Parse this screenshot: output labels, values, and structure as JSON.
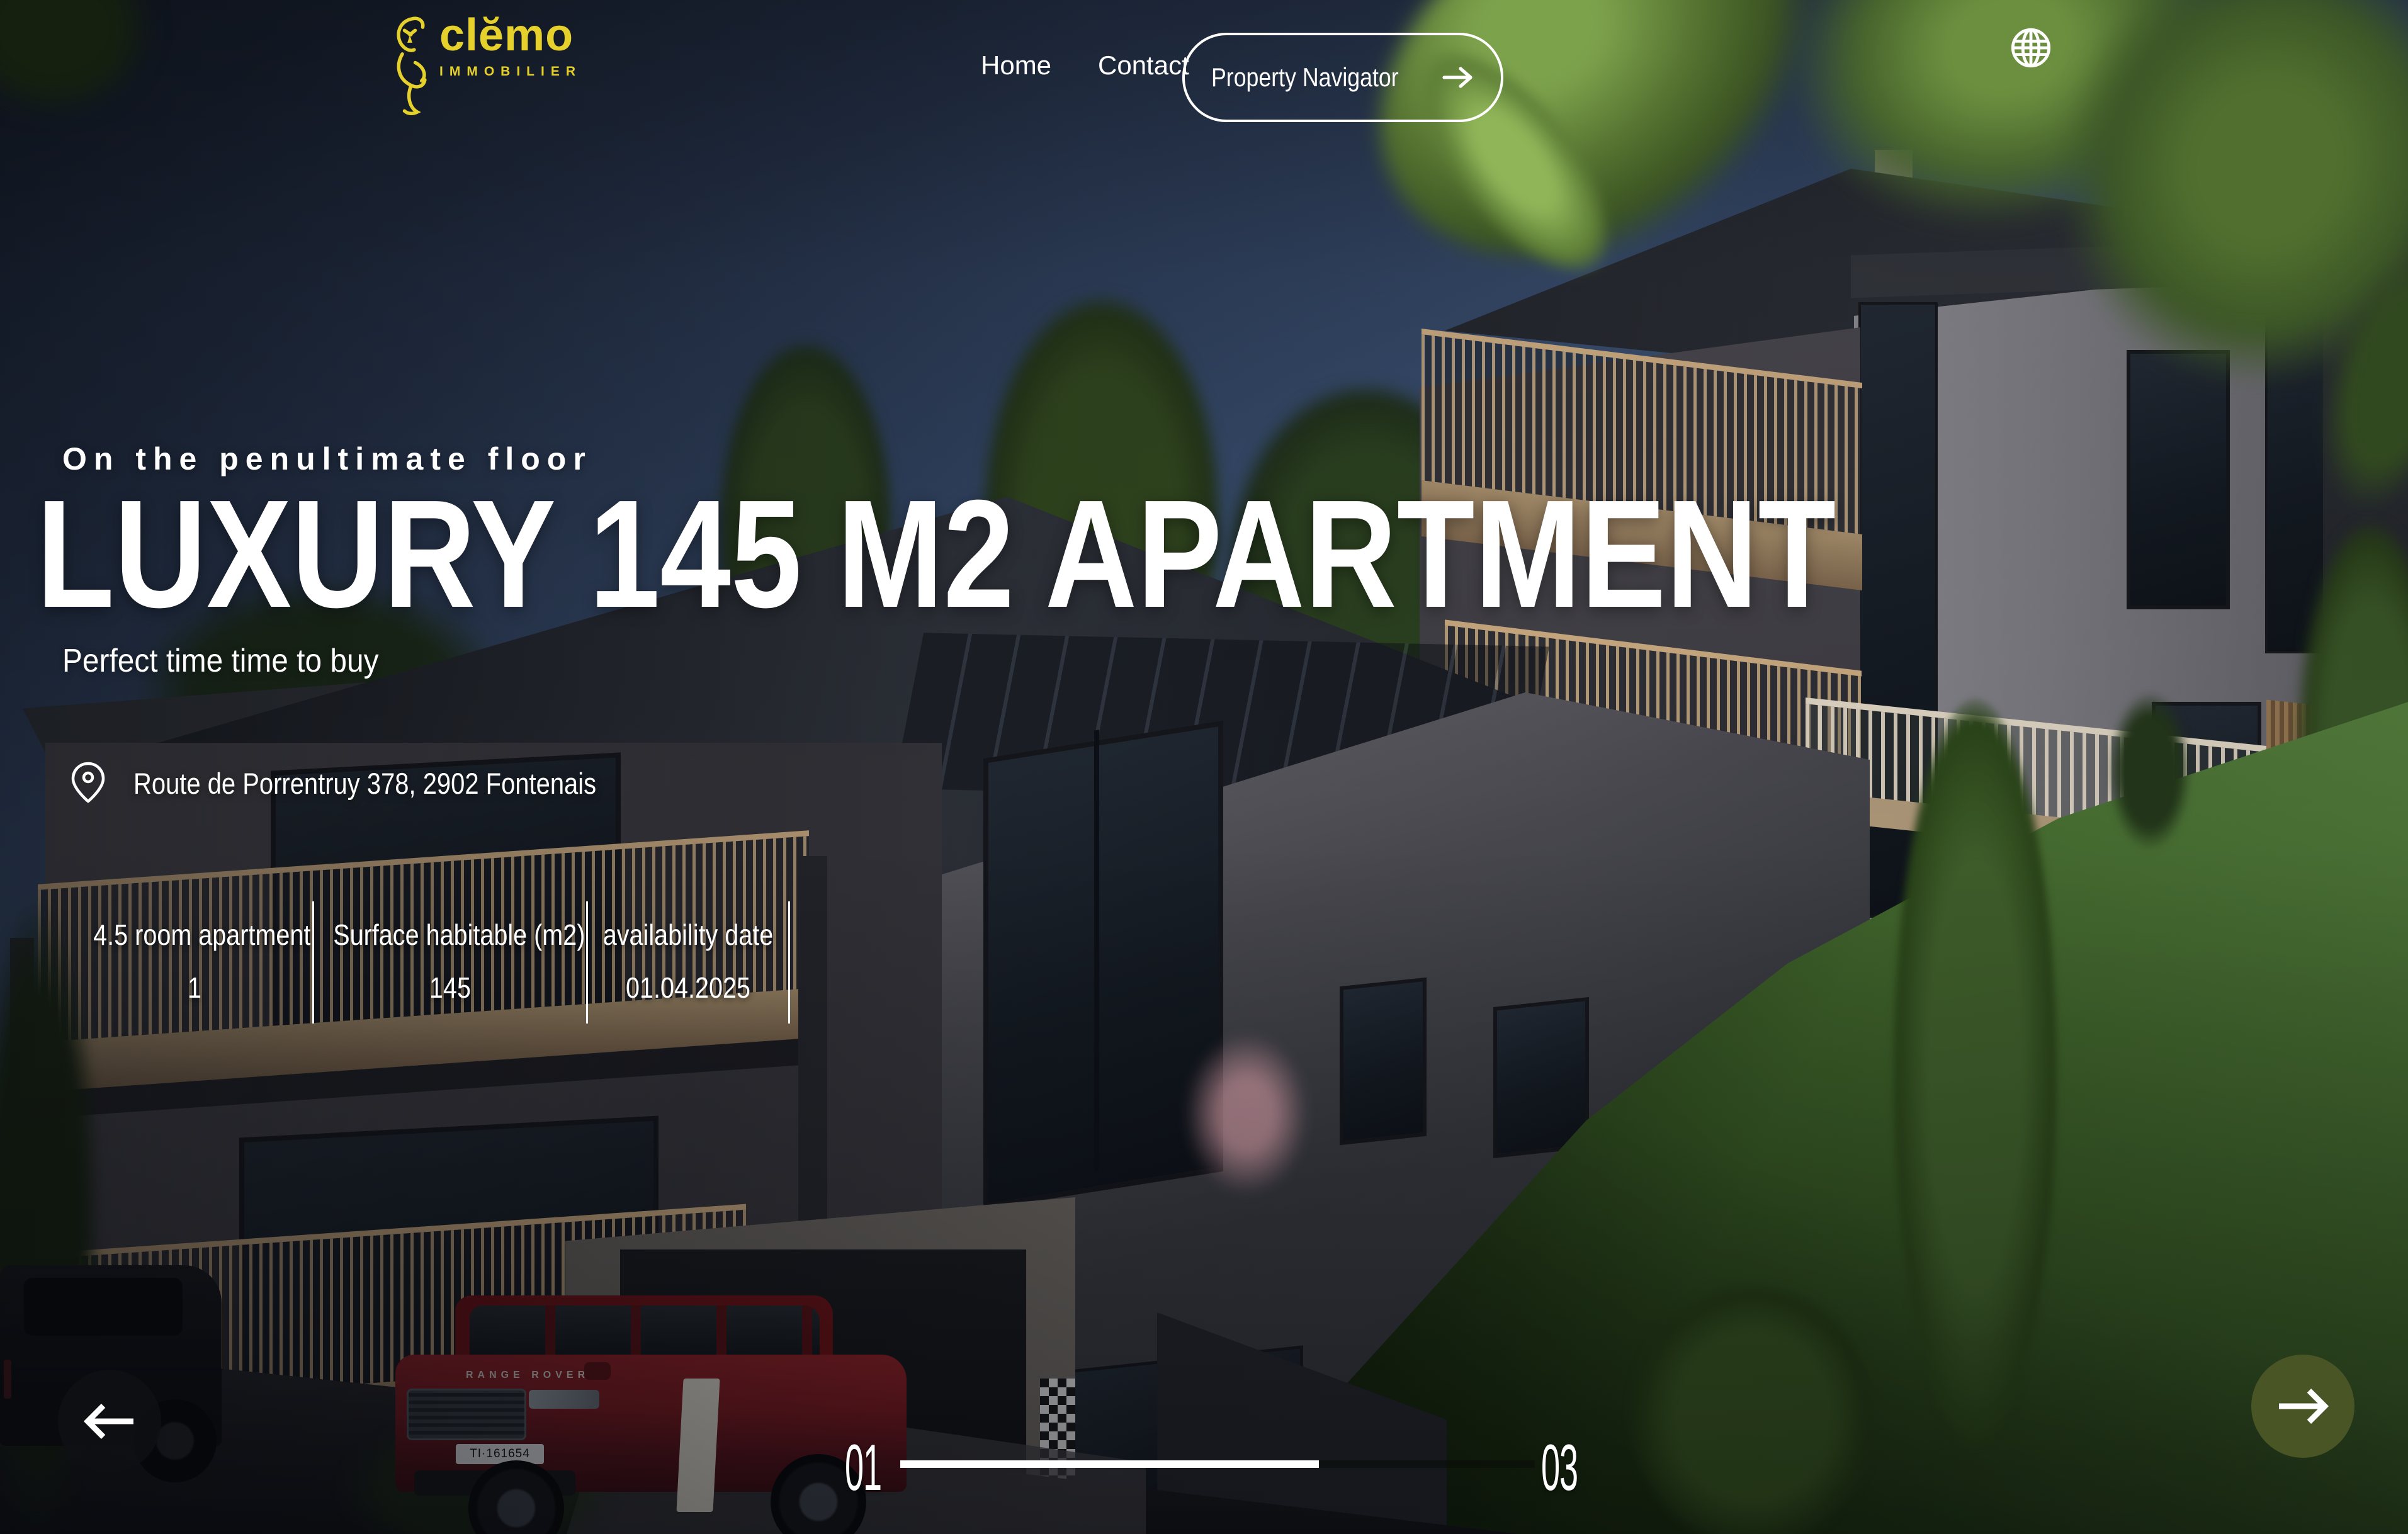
{
  "brand": {
    "name": "clĕmo",
    "subtitle": "IMMOBILIER",
    "accent_color": "#e6d02b"
  },
  "nav": {
    "home": "Home",
    "contact": "Contact",
    "cta": "Property Navigator"
  },
  "hero": {
    "eyebrow": "On the penultimate floor",
    "title": "LUXURY 145 M2 APARTMENT",
    "subtitle": "Perfect time time to buy",
    "address": "Route de Porrentruy 378, 2902 Fontenais",
    "stats": [
      {
        "label": "4.5 room apartment",
        "value": "1"
      },
      {
        "label": "Surface habitable (m2)",
        "value": "145"
      },
      {
        "label": "availability date",
        "value": "01.04.2025"
      }
    ]
  },
  "slider": {
    "current": "01",
    "total": "03",
    "progress_percent": 66
  },
  "scene": {
    "car_brand": "RANGE ROVER",
    "car_plate": "TI·161654"
  },
  "colors": {
    "accent_yellow": "#e6d02b",
    "next_button_olive": "#4a5526",
    "sky_top": "#1a2231",
    "sky_bottom": "#567a9f"
  }
}
